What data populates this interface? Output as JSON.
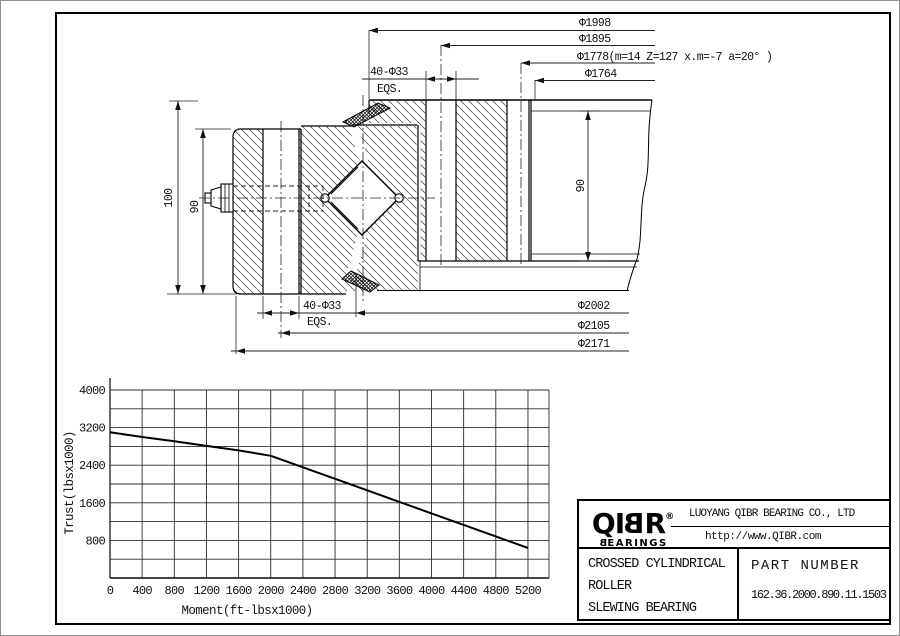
{
  "drawing": {
    "dims": {
      "d1998": "Φ1998",
      "d1895": "Φ1895",
      "d1778": "Φ1778(m=14 Z=127 x.m=-7 a=20° )",
      "d1764": "Φ1764",
      "d2002": "Φ2002",
      "d2105": "Φ2105",
      "d2171": "Φ2171",
      "holes_top": "40-Φ33",
      "holes_top_note": "EQS.",
      "holes_bottom": "40-Φ33",
      "holes_bottom_note": "EQS.",
      "height_overall": "100",
      "height_inner": "90",
      "height_outer": "90"
    }
  },
  "chart_data": {
    "type": "line",
    "title": "",
    "xlabel": "Moment(ft-lbsx1000)",
    "ylabel": "Trust(lbsx1000)",
    "xlim": [
      0,
      5450
    ],
    "ylim": [
      0,
      4000
    ],
    "grid": true,
    "grid_step_x": 400,
    "grid_step_y": 400,
    "legend_position": "none",
    "x_ticks": [
      0,
      400,
      800,
      1200,
      1600,
      2000,
      2400,
      2800,
      3200,
      3600,
      4000,
      4400,
      4800,
      5200
    ],
    "y_ticks": [
      800,
      1600,
      2400,
      3200,
      4000
    ],
    "series": [
      {
        "name": "thrust-moment-capacity",
        "points": [
          [
            0,
            3100
          ],
          [
            400,
            3000
          ],
          [
            800,
            2910
          ],
          [
            1200,
            2810
          ],
          [
            1600,
            2715
          ],
          [
            2000,
            2600
          ],
          [
            2400,
            2355
          ],
          [
            2800,
            2110
          ],
          [
            3200,
            1865
          ],
          [
            3600,
            1620
          ],
          [
            4000,
            1375
          ],
          [
            4400,
            1130
          ],
          [
            4800,
            885
          ],
          [
            5200,
            640
          ]
        ]
      }
    ]
  },
  "title_block": {
    "logo": {
      "c1": "Q",
      "c2": "I",
      "c3": "B",
      "c4": "R",
      "reg": "®",
      "sub_b": "B",
      "sub_rest": "EARINGS"
    },
    "company": "LUOYANG QIBR BEARING CO., LTD",
    "website": "http://www.QIBR.com",
    "product": {
      "line1": "CROSSED CYLINDRICAL",
      "line2": "ROLLER",
      "line3": "SLEWING BEARING"
    },
    "part_number_label": "PART NUMBER",
    "part_number": "162.36.2000.890.11.1503"
  }
}
